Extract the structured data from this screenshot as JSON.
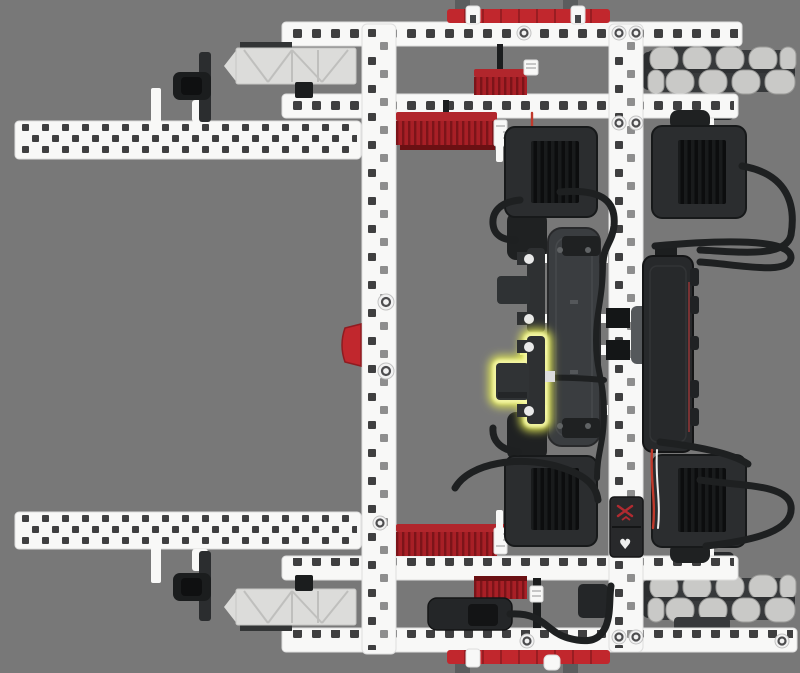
{
  "canvas": {
    "label": "robot-3d-view",
    "width": 800,
    "height": 673
  },
  "scene": {
    "subject": "VEX robot drivetrain build step, top view render",
    "highlighted_part": "shaft-bracket-center",
    "sensor_glyph": "♥"
  },
  "colors": {
    "bg": "#787878",
    "plasticWhite": "#f8f8f7",
    "plasticEdge": "#dedede",
    "holeDark": "#3f3f40",
    "holeMid": "#8e8e8e",
    "vexRed": "#c1272d",
    "vexRedDark": "#8f1b20",
    "gearRed": "#a81f26",
    "gearRedDark": "#7c1419",
    "gearRedDeep": "#6b1013",
    "partDark": "#2b2d2f",
    "partBlack": "#1b1d1e",
    "plateGray": "#3a3d40",
    "moduleGray": "#55585b",
    "trussGray": "#dcdcda",
    "trussLine": "#bfbfbd",
    "rollerGray": "#c9c9c7",
    "rollerEdge": "#9b9b99",
    "hubGray": "#37393b",
    "cable": "#1e2021",
    "wireRed": "#c0392b",
    "wireWhite": "#eeeeee",
    "glow": "#e6ec55",
    "glowInner": "#f4f7a6"
  },
  "parts": [
    "long-beam-top-left",
    "long-beam-bottom-left",
    "bracket-wheel-top-left",
    "bracket-wheel-bottom-left",
    "truss-plate-top",
    "truss-plate-bottom",
    "frame-beam-top",
    "frame-beam-upper",
    "frame-beam-lower",
    "frame-beam-bottom",
    "rubber-rail-top",
    "rubber-rail-bottom",
    "c-channel-left",
    "c-channel-right",
    "gear-train-top",
    "gear-train-bottom",
    "smart-motor-top-center",
    "smart-motor-top-right",
    "smart-motor-bottom-center",
    "smart-motor-bottom-right",
    "omni-wheel-top-right",
    "omni-wheel-bottom-right",
    "battery-plate",
    "robot-brain",
    "radio-module",
    "touch-led-sensor",
    "shaft-bracket-upper",
    "shaft-bracket-center-highlighted",
    "red-clip-left",
    "motor-cables"
  ]
}
